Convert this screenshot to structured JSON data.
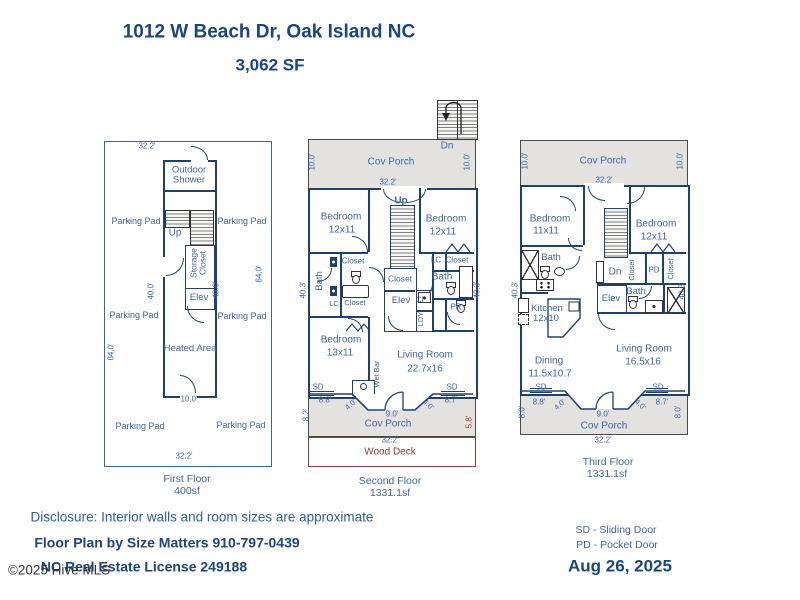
{
  "title": {
    "address": "1012 W Beach Dr, Oak Island NC",
    "sqft": "3,062 SF"
  },
  "common": {
    "cov_porch": "Cov Porch",
    "parking_pad": "Parking Pad",
    "bedroom": "Bedroom",
    "closet": "Closet",
    "bath": "Bath",
    "elev": "Elev",
    "up": "Up",
    "dn": "Dn",
    "sd": "SD",
    "lc": "LC",
    "living_room": "Living Room"
  },
  "dims": {
    "d32_2": "32.2'",
    "d10_0": "10.0'",
    "d40_0": "40.0'",
    "d64_0": "64.0'",
    "d40_3": "40.3'",
    "d8_8": "8.8'",
    "d4_0": "4.0'",
    "d9_0": "9.0'",
    "d8_7": "8.7'",
    "d8_2": "8.2'",
    "d5_8": "5.8'",
    "d8_0": "8.0'"
  },
  "floor1": {
    "outdoor_shower": "Outdoor\nShower",
    "storage_closet": "Storage\nCloset",
    "heated_area": "Heated Area",
    "caption": "First Floor",
    "area": "400sf"
  },
  "floor2": {
    "bedroom_left_size": "12x11",
    "bedroom_right_size": "12x11",
    "bedroom_bottom_size": "13x11",
    "living_room_size": "22.7x16",
    "wet_bar": "Wet Bar",
    "cl": "CL",
    "ldy": "LDY",
    "pr": "PR",
    "wood_deck": "Wood Deck",
    "caption": "Second Floor",
    "area": "1331.1sf"
  },
  "floor3": {
    "bedroom_left_size": "11x11",
    "bedroom_right_size": "12x11",
    "kitchen": "Kitchen",
    "kitchen_size": "12x10",
    "dining": "Dining",
    "dining_size": "11.5x10.7",
    "living_room_size": "16.5x16",
    "pd": "PD",
    "caption": "Third Floor",
    "area": "1331.1sf"
  },
  "footer": {
    "disclosure": "Disclosure: Interior walls and room sizes are approximate",
    "byline": "Floor Plan by Size Matters 910-797-0439",
    "license": "NC Real Estate License 249188",
    "legend_sd": "SD - Sliding Door",
    "legend_pd": "PD - Pocket Door",
    "date": "Aug 26, 2025",
    "copyright": "©2025 Hive MLS"
  },
  "colors": {
    "wall": "#1e4270",
    "label": "#3c63a8",
    "title": "#1a4484",
    "porch_fill": "#e4e2df",
    "deck_red": "#8e3b33",
    "stair_gray": "#808080"
  }
}
